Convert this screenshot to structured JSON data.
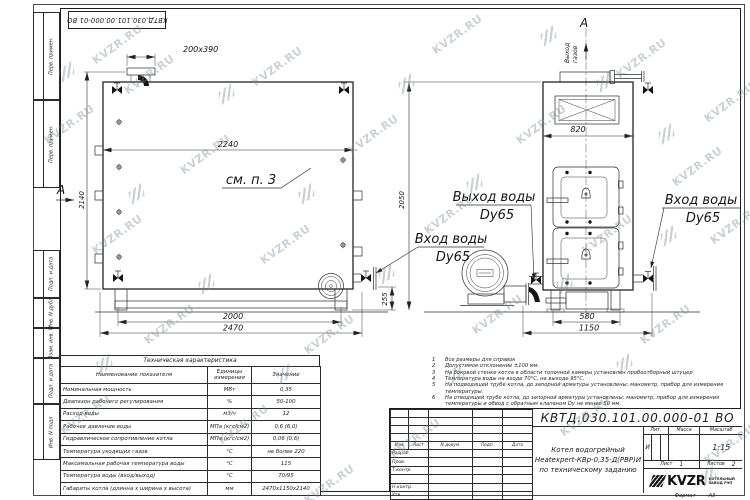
{
  "watermark": {
    "text": "KVZR.RU"
  },
  "stamp": {
    "code": "КВТД.030.101.00.000-01 ВО"
  },
  "frame": {
    "top_boxes": [
      "Перв. примен.",
      "Перв. примен."
    ],
    "bottom_boxes": [
      "Подп. и дата",
      "Инв. N дубл",
      "Взам. инв. N",
      "Подп. и дата",
      "Инв. N подл"
    ]
  },
  "drawing": {
    "dims": {
      "flue": "200x390",
      "width_top": "2240",
      "height_side": "2140",
      "base_side": "2000",
      "length_side": "2470",
      "lift": "255",
      "height_front": "2050",
      "width_front": "820",
      "base_front": "580",
      "length_front": "1150"
    },
    "labels": {
      "section": "А",
      "see_note": "см. п. 3",
      "gas_out_1": "Выход",
      "gas_out_2": "газов",
      "water_out": "Выход воды",
      "water_in": "Вход воды",
      "dy": "Dy65"
    }
  },
  "notes": [
    {
      "n": "1",
      "text": "Все размеры для справок"
    },
    {
      "n": "2",
      "text": "Допустимое отклонение ±100 мм."
    },
    {
      "n": "3",
      "text": "На боковой стенке котла в области топочной камеры установлен пробоотборный штуцер"
    },
    {
      "n": "4",
      "text": "Температура воды на входе 70°С, на выходе 95°С."
    },
    {
      "n": "5",
      "text": "На подводящей трубе котла, до запорной арматуры установлены: манометр, прибор для измерения температуры."
    },
    {
      "n": "6",
      "text": "На отводящей трубе котла, до запорной арматуры установлены: манометр, прибор для измерения температуры и обвод с обратным клапаном Dy не менее 50 мм."
    },
    {
      "n": "7",
      "text": "Остальные технические требования по ОСТ 108.030.133-84."
    }
  ],
  "spec_table": {
    "title": "Техническая характеристика",
    "headers": [
      "Наименование показателя",
      "Единицы измерения",
      "Значение"
    ],
    "rows": [
      [
        "Номинальная мощность",
        "МВт",
        "0,35"
      ],
      [
        "Диапазон рабочего регулирования",
        "%",
        "50-100"
      ],
      [
        "Расход воды",
        "м3/ч",
        "12"
      ],
      [
        "Рабочее давление воды",
        "МПа (кгс/см2)",
        "0,6 (6,0)"
      ],
      [
        "Гидравлическое сопротивление котла",
        "МПа (кгс/см2)",
        "0,06 (0,6)"
      ],
      [
        "Температура уходящих газов",
        "°С",
        "не более 220"
      ],
      [
        "Максимальная рабочая температура воды",
        "°С",
        "115"
      ],
      [
        "Температура воды (вход/выход)",
        "°С",
        "70/95"
      ],
      [
        "Габариты котла (длинна х ширина х высота)",
        "мм",
        "2470х1150х2140"
      ]
    ]
  },
  "title_block": {
    "doc_number": "КВТД.030.101.00.000-01 ВО",
    "name_lines": [
      "Котел водогрейный",
      "Heatexpert-КВр-0,35-Д(РВР)И",
      "по техническому заданию"
    ],
    "change_cols": [
      "Изм.",
      "Лист",
      "N докум.",
      "Подп.",
      "Дата"
    ],
    "sign_rows": [
      "Разраб.",
      "Пров.",
      "Т.контр.",
      "",
      "Н.контр.",
      "Утв."
    ],
    "lit_header": "Лит.",
    "mass_header": "Масса",
    "scale_header": "Масштаб",
    "litera": "И",
    "scale": "1:15",
    "sheet_label": "Лист",
    "sheet_value": "1",
    "sheets_label": "Листов",
    "sheets_value": "2",
    "logo_text": "KVZR",
    "logo_sub1": "КОТЕЛЬНЫЙ",
    "logo_sub2": "ЗАВОД РЭП",
    "format_label": "Формат",
    "format_value": "А3"
  }
}
